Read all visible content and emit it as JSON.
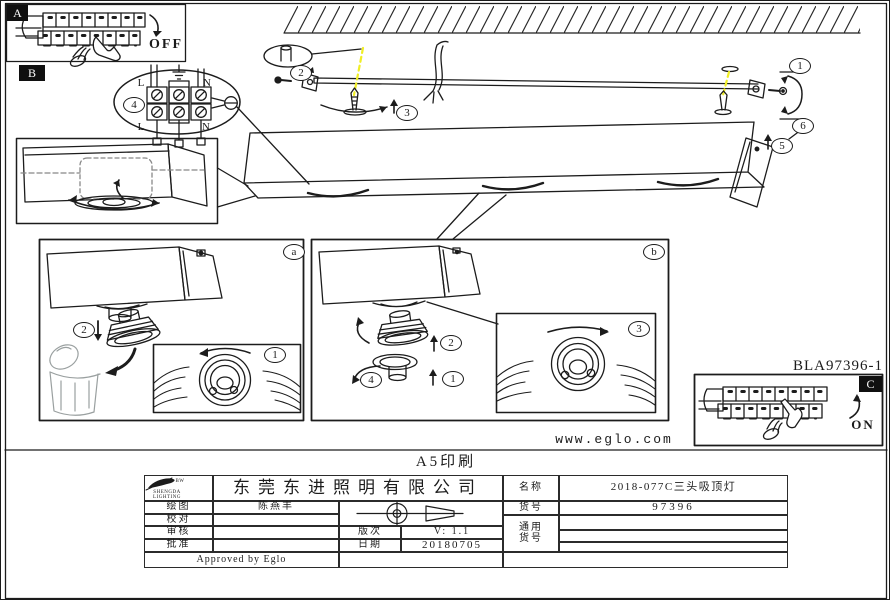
{
  "doc": {
    "product_code": "BLA97396-1",
    "website": "www.eglo.com",
    "print_note": "A5印刷"
  },
  "panels": {
    "a": "A",
    "b": "B",
    "c": "C",
    "off": "OFF",
    "on": "ON"
  },
  "wiring": {
    "live": "L",
    "neutral": "N"
  },
  "callouts": {
    "n1": "1",
    "n2": "2",
    "n3": "3",
    "n4": "4",
    "n5": "5",
    "n6": "6",
    "box_a": "a",
    "box_b": "b"
  },
  "title_block": {
    "logo_line1": "SHENGDA",
    "logo_line2": "LIGHTING",
    "logo_suffix": "BW",
    "company": "东莞东进照明有限公司",
    "draw_label": "绘图",
    "draw_value": "陈燕丰",
    "check_label": "校对",
    "audit_label": "审核",
    "approve_label": "批准",
    "version_label": "版次",
    "version_value": "V: 1.1",
    "date_label": "日期",
    "date_value": "20180705",
    "name_label": "名称",
    "name_value": "2018-077C三头吸顶灯",
    "item_label": "货号",
    "item_value": "97396",
    "common_label_1": "通用",
    "common_label_2": "货号",
    "approved": "Approved by Eglo"
  },
  "colors": {
    "highlight": "#f0ee25",
    "ink": "#1c1c1c",
    "sketch_gray": "#9aa0a0"
  }
}
